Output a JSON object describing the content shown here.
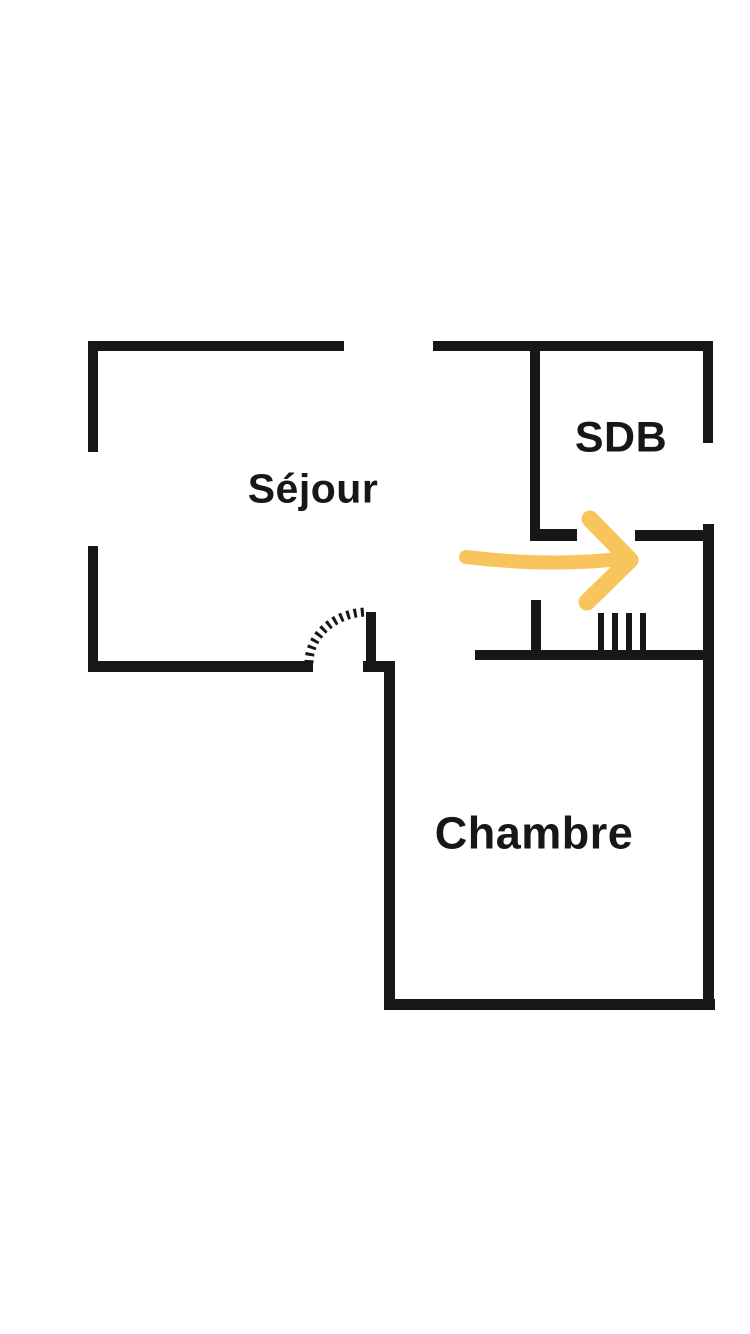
{
  "page": {
    "type": "apartment-floor-plan"
  },
  "rooms": {
    "sejour": {
      "label": "Séjour"
    },
    "sdb": {
      "label": "SDB"
    },
    "chambre": {
      "label": "Chambre"
    }
  },
  "annotation": {
    "arrow_icon": "arrow-right-icon",
    "arrow_color": "#F8C45C"
  },
  "symbols": {
    "door_swing": "dashed-quarter-arc-door-swing",
    "comb": "four-tick-radiator-symbol"
  },
  "colors": {
    "wall": "#171717",
    "text": "#171717",
    "background": "#FFFFFF"
  }
}
